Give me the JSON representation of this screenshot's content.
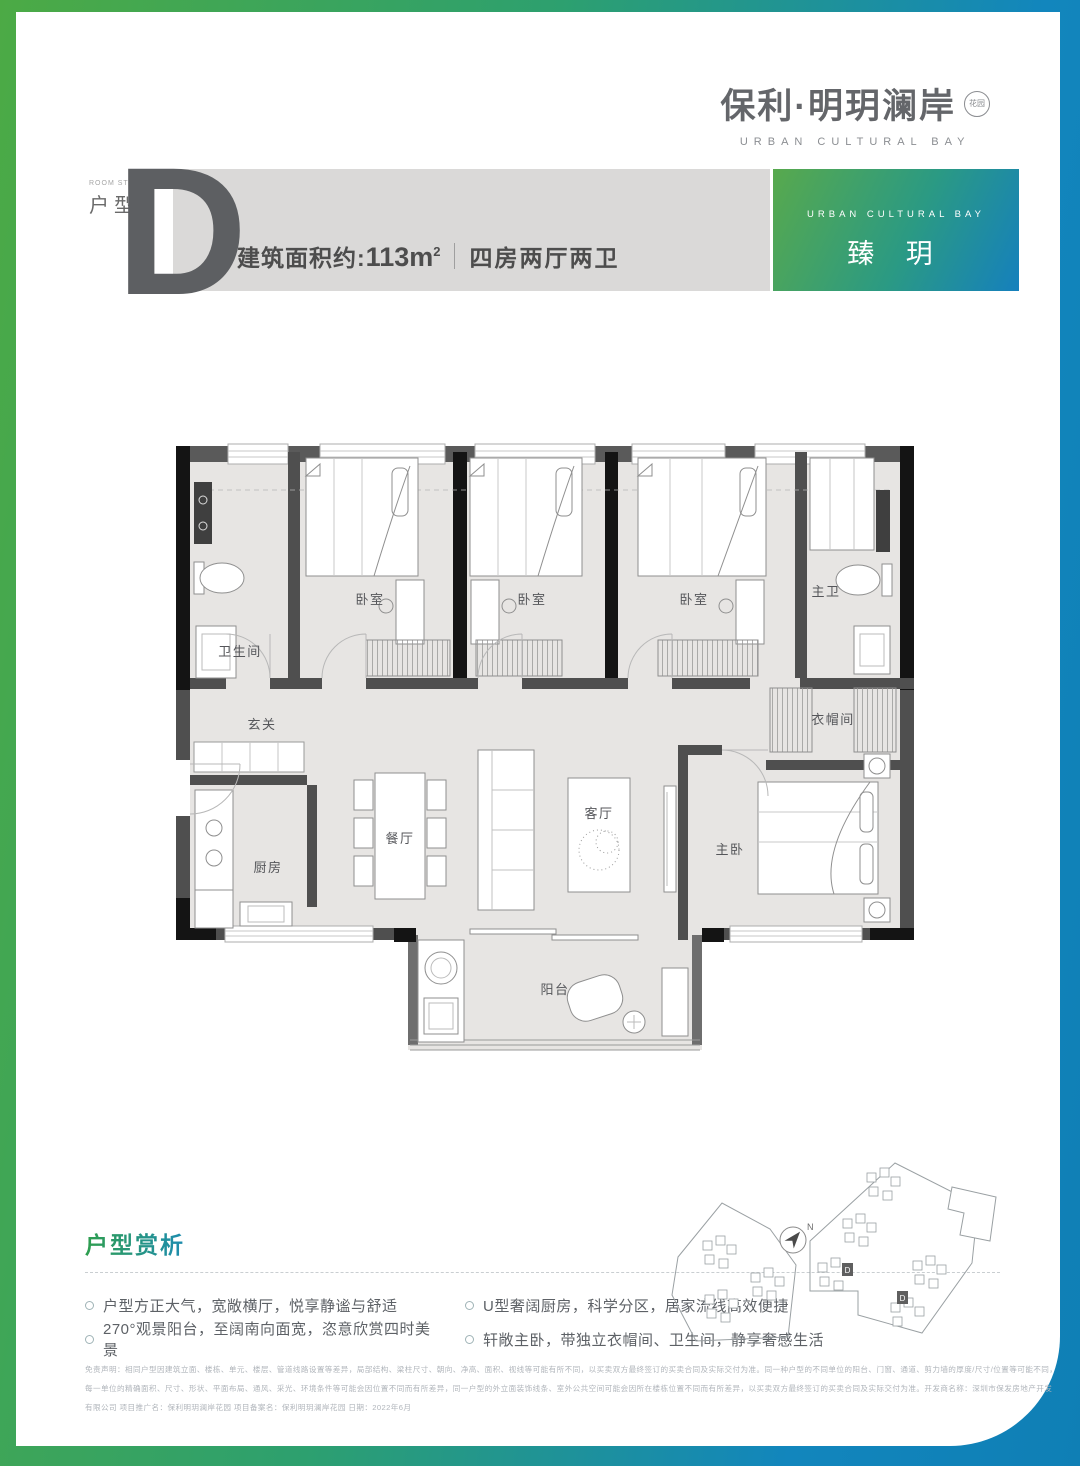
{
  "colors": {
    "frame_green": "#4caa45",
    "frame_blue": "#1286bd",
    "banner_gray": "#dad9d8",
    "wall_dark": "#4f4f4f",
    "wall_black": "#141414",
    "floor_gray": "#e7e5e3",
    "title_gradient_green": "#2f9e4e",
    "title_gradient_blue": "#1d8cb0"
  },
  "logo": {
    "name_cn": "保利·明玥澜岸",
    "seal": "花园",
    "name_en": "URBAN CULTURAL BAY"
  },
  "header": {
    "room_style_en": "ROOM STYLE",
    "room_style_cn": "户型",
    "type_letter": "D",
    "area_label": "建筑面积约:",
    "area_value": "113m",
    "area_sup": "2",
    "spec": "四房两厅两卫",
    "badge_en": "URBAN CULTURAL BAY",
    "badge_cn": "臻 玥"
  },
  "floorplan": {
    "labels": {
      "bath": "卫生间",
      "bedroom1": "卧室",
      "bedroom2": "卧室",
      "bedroom3": "卧室",
      "master_bath": "主卫",
      "foyer": "玄关",
      "cloakroom": "衣帽间",
      "kitchen": "厨房",
      "dining": "餐厅",
      "living": "客厅",
      "master_bedroom": "主卧",
      "balcony": "阳台"
    }
  },
  "siteplan": {
    "north": "N",
    "unit_d1": "D",
    "unit_d2": "D"
  },
  "analysis": {
    "title": "户型赏析",
    "bullets": [
      "户型方正大气，宽敞横厅，悦享静谧与舒适",
      "270°观景阳台，至阔南向面宽，恣意欣赏四时美景",
      "U型奢阔厨房，科学分区，居家流线高效便捷",
      "轩敞主卧，带独立衣帽间、卫生间，静享奢感生活"
    ]
  },
  "disclaimer": {
    "lines": [
      "免责声明：相同户型因建筑立面、楼栋、单元、楼层、管道线路设置等差异，局部结构、梁柱尺寸、朝向、净高、面积、视线等可能有所不同，以买卖双方最终签订的买卖合同及实际交付为准。同一种户型的不同单位的阳台、门窗、通道、剪力墙的厚度/尺寸/位置等可能不同，",
      "每一单位的精确面积、尺寸、形状、平面布局、通风、采光、环境条件等可能会因位置不同而有所差异，同一户型的外立面装饰线条、室外公共空间可能会因所在楼栋位置不同而有所差异，以买卖双方最终签订的买卖合同及实际交付为准。开发商名称：深圳市保发房地产开发",
      "有限公司 项目推广名：保利明玥澜岸花园 项目备案名：保利明玥澜岸花园 日期：2022年6月"
    ]
  }
}
